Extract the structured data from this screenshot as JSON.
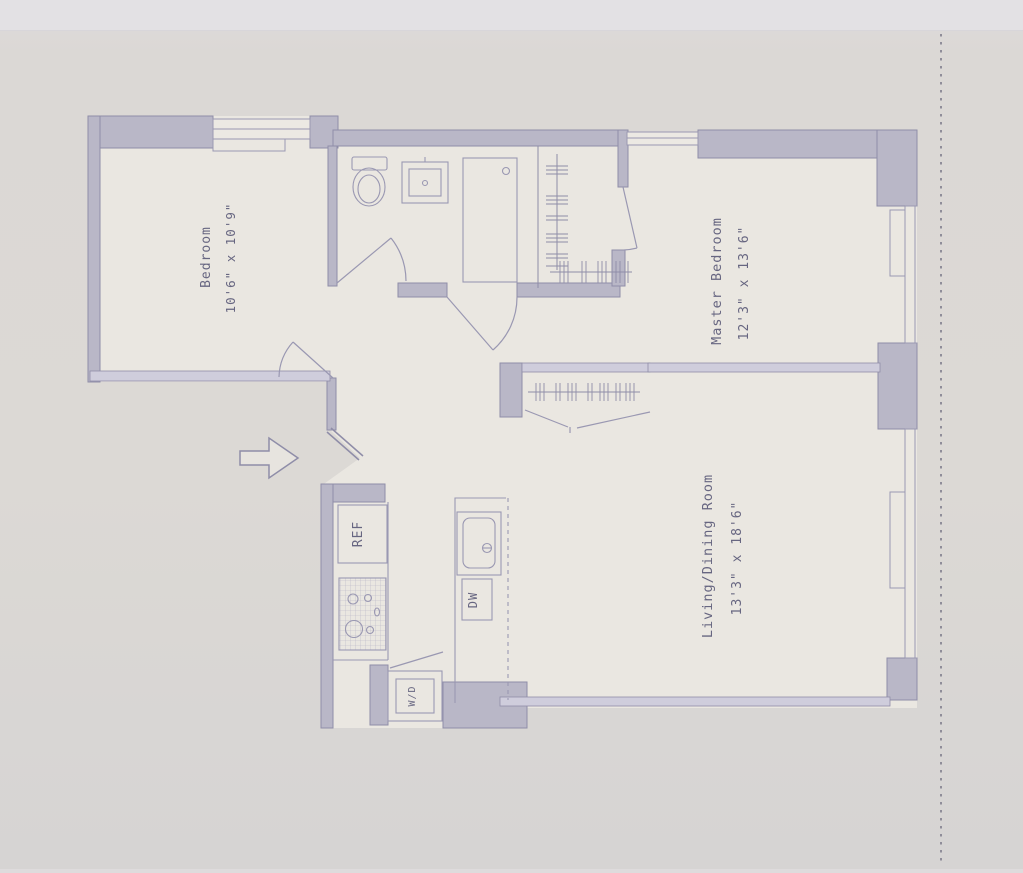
{
  "floor_plan": {
    "rooms": [
      {
        "id": "bedroom",
        "name": "Bedroom",
        "dimensions": "10'6\" x 10'9\""
      },
      {
        "id": "master-bedroom",
        "name": "Master Bedroom",
        "dimensions": "12'3\" x 13'6\""
      },
      {
        "id": "living-dining",
        "name": "Living/Dining Room",
        "dimensions": "13'3\" x 18'6\""
      }
    ],
    "appliances": [
      {
        "id": "refrigerator",
        "label": "REF"
      },
      {
        "id": "dishwasher",
        "label": "DW"
      },
      {
        "id": "washer-dryer",
        "label": "W/D"
      }
    ],
    "colors": {
      "wall": "#b9b7c7",
      "wall_stroke": "#8f8da8",
      "thin_wall": "#cfcddc",
      "line": "#9a98b2",
      "label": "#565574",
      "paper": "#eae7e1",
      "background": "#dcd9d5"
    }
  }
}
